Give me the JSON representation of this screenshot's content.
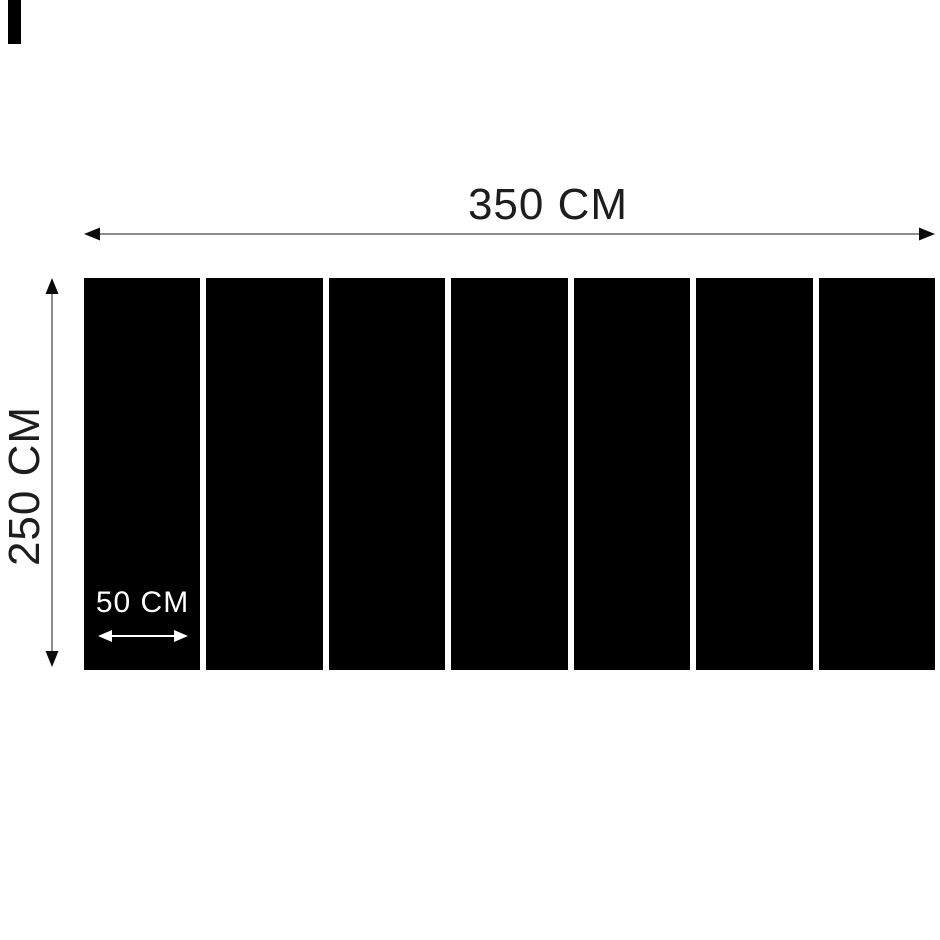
{
  "diagram": {
    "width_label": "350 CM",
    "height_label": "250 CM",
    "slat_width_label": "50 CM",
    "panel_count": 7,
    "dimensions": {
      "total_width_cm": 350,
      "total_height_cm": 250,
      "slat_width_cm": 50
    },
    "colors": {
      "background": "#ffffff",
      "panel": "#000000",
      "dimension_line": "#8c8c8c",
      "arrowhead": "#0b0b0b",
      "label_text": "#1d1d1d",
      "panel_label_text": "#ffffff"
    }
  }
}
